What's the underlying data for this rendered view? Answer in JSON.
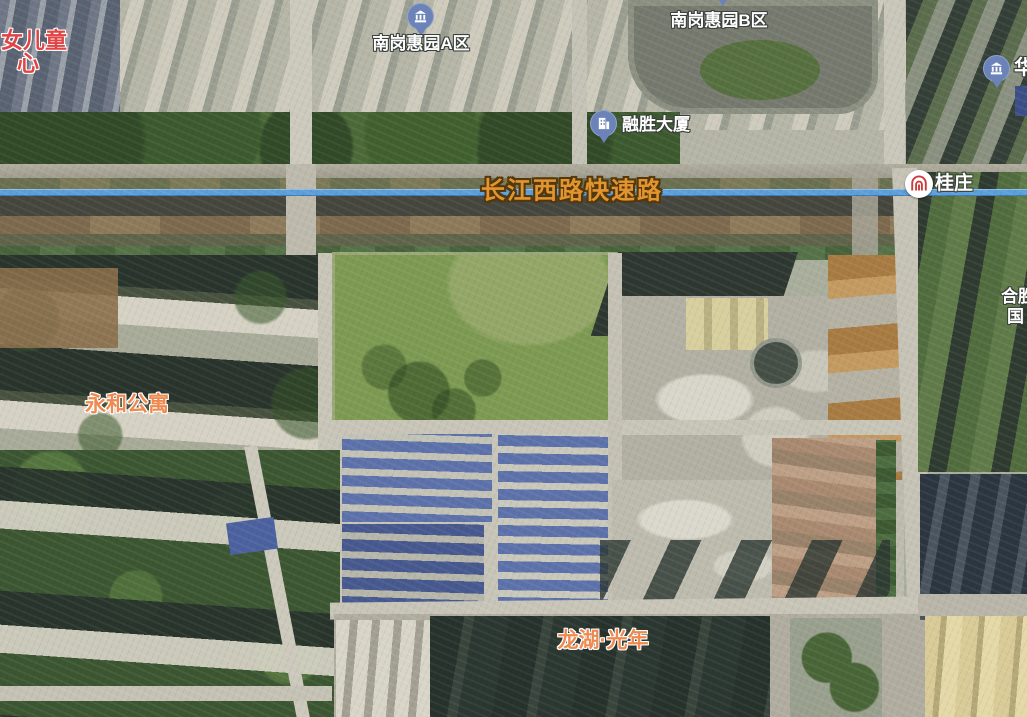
{
  "map": {
    "view": "satellite",
    "road_label": "长江西路快速路",
    "metro_station": {
      "name": "桂庄"
    },
    "poi_markers": [
      {
        "label": "南岗惠园A区"
      },
      {
        "label": "南岗惠园B区"
      },
      {
        "label": "融胜大厦"
      },
      {
        "label": "华"
      }
    ],
    "area_labels": [
      {
        "label": "永和公寓"
      },
      {
        "label": "龙湖·光年"
      }
    ],
    "partial_labels": [
      {
        "line1": "女儿童",
        "line2": "心"
      },
      {
        "line1": "合胜",
        "line2": "国"
      }
    ],
    "colors": {
      "route_line": "#5d9fdb",
      "road_label": "#e2952f",
      "area_label": "#ee8a50",
      "partial_red": "#e04444",
      "metro_logo": "#cf3b3b",
      "poi_pin": "#6b83b9"
    }
  }
}
